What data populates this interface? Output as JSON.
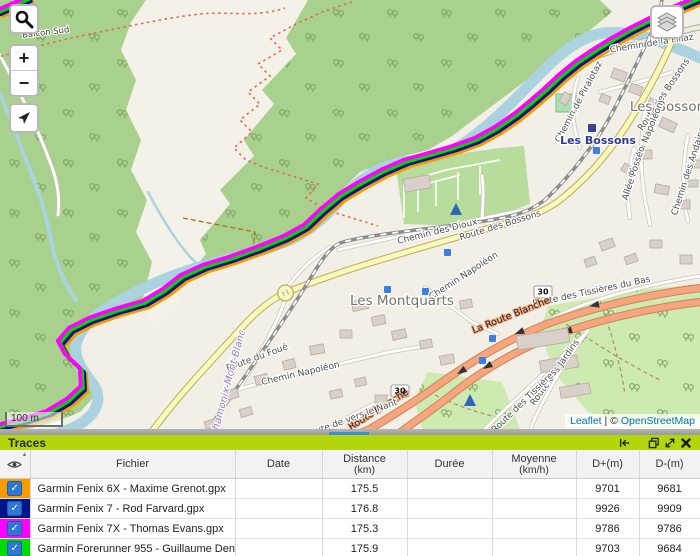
{
  "colors": {
    "panel_green": "#b2d60b",
    "resize_thumb_blue": "#3e8fd0",
    "checkbox_blue": "#2e77d4",
    "water": "#aad3df",
    "forest": "#a8d18d",
    "trunk_road": "#f5a67e",
    "secondary_road": "#f7fabe"
  },
  "map": {
    "scale_label": "100 m",
    "attribution": {
      "leaflet": "Leaflet",
      "separator": "|",
      "copyright": "©",
      "osm": "OpenStreetMap"
    },
    "controls": {
      "zoom_in": "+",
      "zoom_out": "−"
    },
    "labels": [
      {
        "t": "Balcon Sud",
        "x": 46,
        "y": 35,
        "r": -7,
        "c": "trail"
      },
      {
        "t": "Chemin de la Filiaz",
        "x": 652,
        "y": 46,
        "r": -9,
        "c": "street"
      },
      {
        "t": "Route des Bossons",
        "x": 666,
        "y": 96,
        "r": -56,
        "c": "street"
      },
      {
        "t": "Chemin de Piralotaz",
        "x": 581,
        "y": 103,
        "r": -62,
        "c": "street"
      },
      {
        "t": "Les Bossons",
        "x": 671,
        "y": 111,
        "r": 0,
        "c": "locality",
        "a": "start"
      },
      {
        "t": "Les Bossons",
        "x": 598,
        "y": 144,
        "r": 0,
        "c": "station"
      },
      {
        "t": "Chemin Napoléon",
        "x": 648,
        "y": 141,
        "r": -68,
        "c": "street"
      },
      {
        "t": "Allée Posséo",
        "x": 636,
        "y": 174,
        "r": -72,
        "c": "street"
      },
      {
        "t": "Chemin des Andains",
        "x": 691,
        "y": 172,
        "r": -72,
        "c": "street"
      },
      {
        "t": "Chemin des Dioux",
        "x": 438,
        "y": 234,
        "r": -14,
        "c": "street"
      },
      {
        "t": "Route des Bossons",
        "x": 501,
        "y": 228,
        "r": -17,
        "c": "street"
      },
      {
        "t": "Chemin Napoléon",
        "x": 465,
        "y": 278,
        "r": -33,
        "c": "street"
      },
      {
        "t": "Les Montquarts",
        "x": 402,
        "y": 305,
        "r": 0,
        "c": "locality"
      },
      {
        "t": "Route des Tissières du Bas",
        "x": 592,
        "y": 294,
        "r": -12,
        "c": "street"
      },
      {
        "t": "La Route Blanche",
        "x": 512,
        "y": 318,
        "r": -22,
        "c": "trunk"
      },
      {
        "t": "Route du Foué",
        "x": 258,
        "y": 360,
        "r": -20,
        "c": "street"
      },
      {
        "t": "Chemin Napoléon",
        "x": 301,
        "y": 376,
        "r": -13,
        "c": "street"
      },
      {
        "t": "Route des Jardins",
        "x": 557,
        "y": 374,
        "r": -55,
        "c": "street"
      },
      {
        "t": "Route des Tissières",
        "x": 526,
        "y": 403,
        "r": -44,
        "c": "street"
      },
      {
        "t": "Route Blanche",
        "x": 380,
        "y": 412,
        "r": -32,
        "c": "trunk"
      },
      {
        "t": "Route de vers le Nant",
        "x": 352,
        "y": 421,
        "r": -20,
        "c": "street"
      },
      {
        "t": "Chamonix-Mont-Blanc",
        "x": 231,
        "y": 384,
        "r": -75,
        "c": "admin"
      },
      {
        "t": "30",
        "x": 543,
        "y": 294.5,
        "r": 0,
        "c": "shield"
      },
      {
        "t": "30",
        "x": 400,
        "y": 393.5,
        "r": 0,
        "c": "shield"
      }
    ]
  },
  "panel": {
    "title": "Traces",
    "columns": [
      {
        "label": "Fichier",
        "sub": ""
      },
      {
        "label": "Date",
        "sub": ""
      },
      {
        "label": "Distance",
        "sub": "(km)"
      },
      {
        "label": "Durée",
        "sub": ""
      },
      {
        "label": "Moyenne",
        "sub": "(km/h)"
      },
      {
        "label": "D+(m)",
        "sub": ""
      },
      {
        "label": "D-(m)",
        "sub": ""
      }
    ],
    "rows": [
      {
        "color": "#f59b00",
        "checked": true,
        "file": "Garmin Fenix 6X - Maxime Grenot.gpx",
        "date": "",
        "distance": "175.5",
        "duration": "",
        "average": "",
        "dplus": "9701",
        "dminus": "9681"
      },
      {
        "color": "#001489",
        "checked": true,
        "file": "Garmin Fenix 7 - Rod Farvard.gpx",
        "date": "",
        "distance": "176.8",
        "duration": "",
        "average": "",
        "dplus": "9926",
        "dminus": "9909"
      },
      {
        "color": "#ff00ff",
        "checked": true,
        "file": "Garmin Fenix 7X - Thomas Evans.gpx",
        "date": "",
        "distance": "175.3",
        "duration": "",
        "average": "",
        "dplus": "9786",
        "dminus": "9786"
      },
      {
        "color": "#00db00",
        "checked": true,
        "file": "Garmin Forerunner 955 - Guillaume Deneff",
        "date": "",
        "distance": "175.9",
        "duration": "",
        "average": "",
        "dplus": "9703",
        "dminus": "9684"
      }
    ]
  }
}
